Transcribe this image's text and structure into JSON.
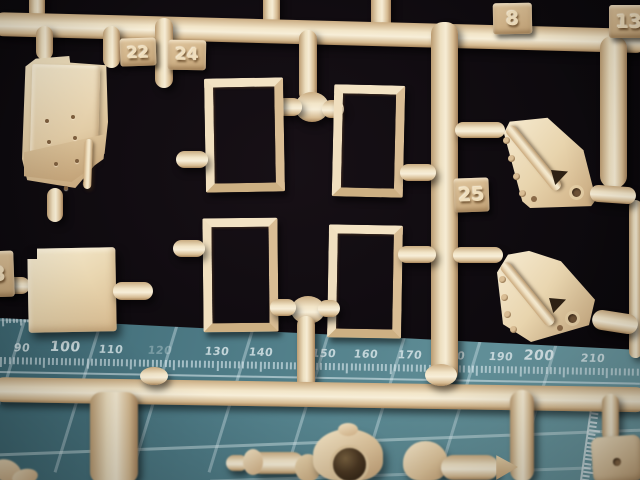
{
  "scene": {
    "type": "macro-photograph",
    "subject": "Tan plastic model-kit sprue (parts tree) over a dark background, above a teal cutting mat with printed millimetre scale",
    "colors": {
      "background": "#0c090d",
      "plastic": "#ecd8b4",
      "plastic_highlight": "#f8efd9",
      "plastic_shadow": "#aa8a60",
      "tab_face": "#d4b78d",
      "tab_number": "#f0debc",
      "mat_teal": "#517d87",
      "mat_grid": "#cfe0e4",
      "scale_text": "#d8e6e9"
    }
  },
  "part_tags": {
    "tag22": "22",
    "tag24": "24",
    "tag8": "8",
    "tag13": "13",
    "tag25": "25",
    "tag_partial_left": "3"
  },
  "mat_scale": {
    "unit_labels": [
      "90",
      "100",
      "110",
      "120",
      "130",
      "140",
      "150",
      "160",
      "170",
      "180",
      "190",
      "200",
      "210"
    ],
    "emphasized_labels": [
      "100",
      "200"
    ]
  }
}
